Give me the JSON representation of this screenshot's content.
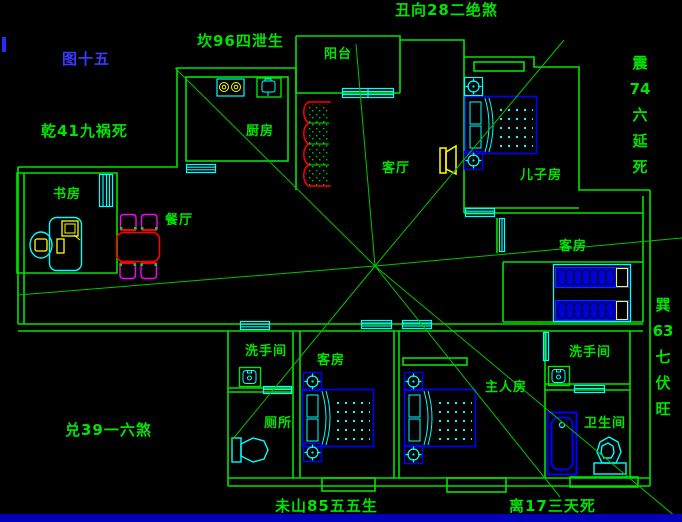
{
  "figure": {
    "label": "图十五"
  },
  "feng_shui_annotations": {
    "top": "坎96四泄生",
    "top_right": "丑向28二绝煞",
    "left_upper": "乾41九祸死",
    "left_lower": "兑39一六煞",
    "right_upper_vertical": [
      "震",
      "74",
      "六",
      "延",
      "死"
    ],
    "right_lower_vertical": [
      "巽",
      "63",
      "七",
      "伏",
      "旺"
    ],
    "bottom_left": "未山85五五生",
    "bottom_right": "离17三天死"
  },
  "room_labels": {
    "balcony": "阳台",
    "kitchen": "厨房",
    "study": "书房",
    "dining": "餐厅",
    "living_room": "客厅",
    "son_room": "儿子房",
    "guest_room_right": "客房",
    "guest_room_bottom": "客房",
    "washroom_left": "洗手间",
    "toilet": "厕所",
    "master_room": "主人房",
    "washroom_right": "洗手间",
    "bathroom": "卫生间"
  },
  "colors": {
    "background": "#000000",
    "wall_green": "#00e400",
    "window_cyan": "#00ffff",
    "furniture_blue": "#0000ff",
    "accent_red": "#ff0000",
    "accent_magenta": "#ff00ff",
    "accent_yellow": "#ffff00",
    "figure_label_blue": "#3a3aff",
    "bottom_bar_blue": "#0000bb"
  }
}
